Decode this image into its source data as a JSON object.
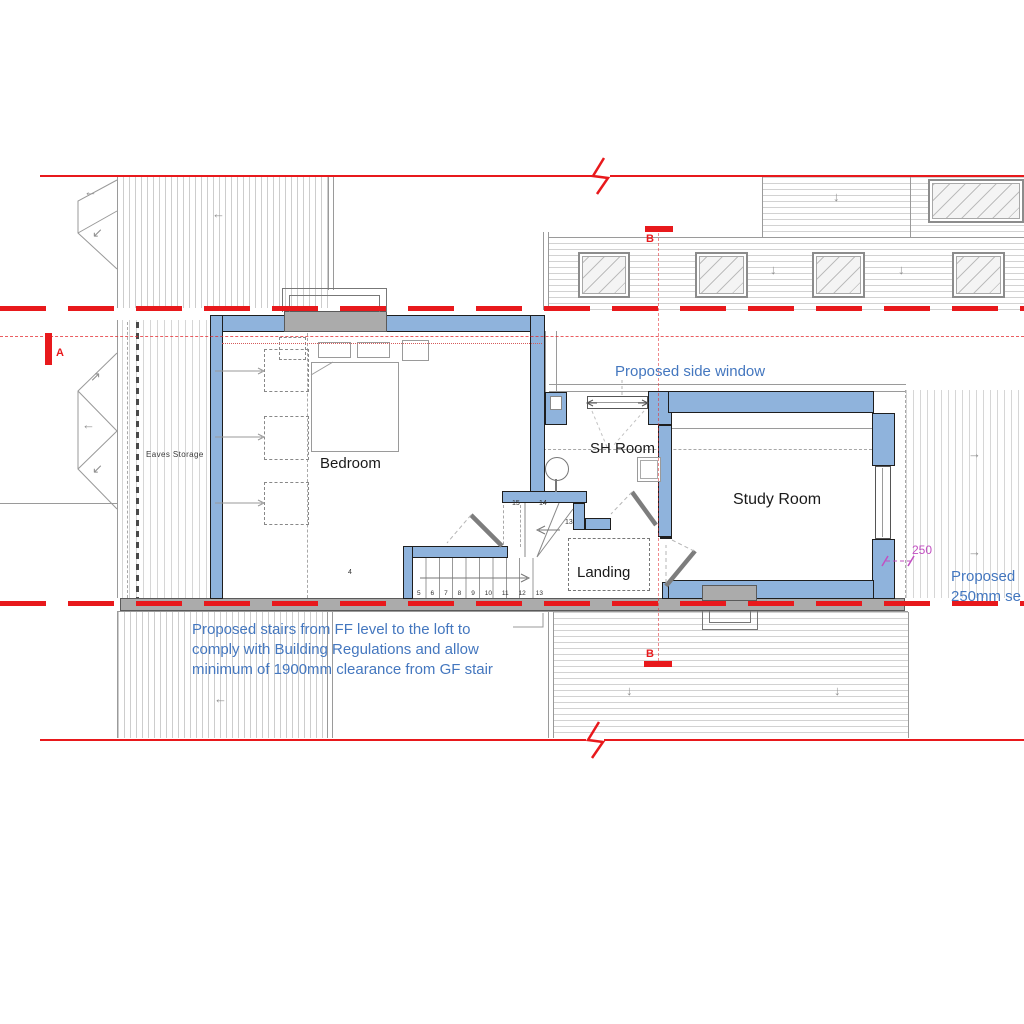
{
  "plan": {
    "title": "Loft floor plan",
    "rooms": {
      "bedroom": "Bedroom",
      "sh_room": "SH Room",
      "study_room": "Study Room",
      "landing": "Landing",
      "eaves_storage": "Eaves Storage"
    },
    "annotations": {
      "side_window": "Proposed side window",
      "stairs_note_line1": "Proposed stairs from FF level to the loft to",
      "stairs_note_line2": "comply with Building Regulations and allow",
      "stairs_note_line3": "minimum of 1900mm clearance from GF stair",
      "right_note_line1": "Proposed",
      "right_note_line2": "250mm se"
    },
    "dimensions": {
      "setback": "250"
    },
    "section_markers": {
      "a": "A",
      "b_top": "B",
      "b_bottom": "B"
    },
    "stair_numbers": {
      "run": [
        "5",
        "6",
        "7",
        "8",
        "9",
        "10",
        "11",
        "12",
        "13"
      ],
      "winder_15": "15",
      "winder_14": "14",
      "corner_13": "13",
      "bedroom_step": "4"
    },
    "icons": {
      "arrow_left": "←",
      "arrow_down": "↓",
      "arrow_right": "→",
      "arrow_up_right": "↗",
      "arrow_down_left": "↙"
    },
    "colors": {
      "wall_blue": "#8FB3DC",
      "section_red": "#E8191C",
      "annotation_blue": "#4477BF",
      "dimension_magenta": "#C24FC2",
      "existing_gray": "#ABABAB"
    }
  }
}
